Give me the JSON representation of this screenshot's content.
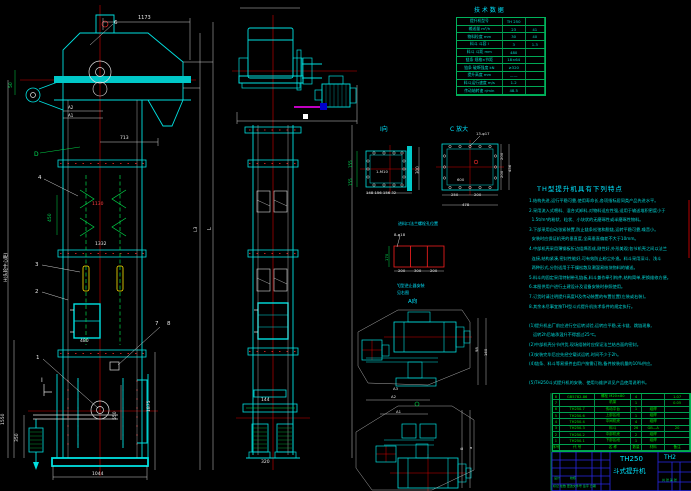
{
  "drawing": {
    "sheet_title": "TH250 斗式提升机",
    "accent_colors": {
      "cyan": "#00e0e0",
      "green": "#00d84a",
      "red": "#ff2e2e",
      "white": "#d8d8d8",
      "yellow": "#ffe800",
      "magenta": "#ff00ff",
      "blue": "#2828e8"
    }
  },
  "features": {
    "title": "TH型提升机具有下列特点",
    "lines": [
      "1.结构先进,运行平稳可靠,使用寿命长,各项指标居同类产品先进水平。",
      "2.采用流入式喂料、混合式卸料,对物料适应性强,适用于输送堆积密度小于",
      "  1.5t/m³的粉状、粒状、小块状的无磨琢性或半磨琢性物料。",
      "3.下部采用自动张紧装置,防止链条松弛和脱链,运转平稳可靠,噪音小。",
      "  安装时应保证机壳的垂直度,全高垂直偏差不大于10mm。",
      "4.中部机壳采用薄钢板折边组焊而成,刚性好,外形美观;各节机壳之间以法兰",
      "  连接,结构紧凑,密封性能好,可有效防止粉尘外逸。料斗采用深斗、浅斗",
      "  两种形式,分别适用于干燥松散及潮湿易结块物料的输送。",
      "5.料斗的固定采用特制带孔链板,料斗兼作牵引构件,结构简单,更换维修方便。",
      "6.本图供用户进行土建设计及设备安装时参照使用。",
      "7.订货时请注明提升高度H及传动装置的布置位置(左装或右装)。",
      "8.其余未尽事宜按TH型斗式提升机技术条件的规定执行。",
      "",
      "(1)提升机出厂前应进行空运转试验,运转应平稳,无卡链、跳链现象,",
      "   运转2h后轴承温升不得超过25℃。",
      "(2)中部机壳分节供货,现场组装时应保证法兰结合面的密封。",
      "(3)安装完毕后应先经空载试运转,时间不少于2h。",
      "(4)链条、料斗等易损件由用户按需订购,备件按装机量的10%供应。",
      "",
      "(5)TH250斗式提升机的安装、使用与维护详见产品使用说明书。"
    ]
  },
  "tech": {
    "title": "技 术 数 据",
    "rows": [
      [
        "提升机型号",
        "TH 250",
        ""
      ],
      [
        "输送量 m³/h",
        "23",
        "41"
      ],
      [
        "物料粒度 mm",
        "30",
        "40"
      ],
      [
        "料斗 斗容 l",
        "3",
        "1.3"
      ],
      [
        "料斗 斗距 mm",
        "480",
        ""
      ],
      [
        "链条 规格×节距",
        "18×64",
        ""
      ],
      [
        "链条 破断强度 kN",
        "≥320",
        ""
      ],
      [
        "提升高度 mm",
        "——",
        ""
      ],
      [
        "料斗运行速度 m/s",
        "1.2",
        ""
      ],
      [
        "传动轴转速 r/min",
        "48.5",
        ""
      ]
    ]
  },
  "bom": {
    "rows": [
      [
        "8",
        "GB5782-86",
        "螺栓 M20×80",
        "4",
        "",
        "1.07"
      ],
      [
        "7",
        "",
        "机架",
        "1",
        "",
        "0.05"
      ],
      [
        "6",
        "TH250.7",
        "传动平台",
        "1",
        "组焊",
        ""
      ],
      [
        "5",
        "TH250.6",
        "上部区段",
        "1",
        "组焊",
        ""
      ],
      [
        "4",
        "TH250.4",
        "中间机壳",
        "4",
        "组焊",
        ""
      ],
      [
        "3",
        "TH250.3",
        "料斗",
        "26",
        "GB—A",
        "20"
      ],
      [
        "2",
        "TH250.2",
        "中部机壳",
        "2",
        "组焊",
        ""
      ],
      [
        "1",
        "TH250.1",
        "下部区段",
        "1",
        "组焊",
        ""
      ],
      [
        "序号",
        "代 号",
        "名 称",
        "数量",
        "材料",
        "备注"
      ]
    ]
  },
  "annotations": [
    {
      "n": "dim-1173",
      "t": "1173",
      "x": 138,
      "y": 16,
      "s": 5,
      "c": "w"
    },
    {
      "n": "part-label-6",
      "t": "6",
      "x": 114,
      "y": 21,
      "s": 5.5,
      "c": "w"
    },
    {
      "n": "dim-50",
      "t": "50",
      "x": 10,
      "y": 88,
      "s": 4.5,
      "c": "g",
      "r": 1
    },
    {
      "n": "dim-label-A2",
      "t": "A2",
      "x": 68,
      "y": 106,
      "s": 4,
      "c": "w"
    },
    {
      "n": "dim-label-A1",
      "t": "A1",
      "x": 68,
      "y": 113.5,
      "s": 4,
      "c": "w"
    },
    {
      "n": "dim-713",
      "t": "713",
      "x": 120,
      "y": 137,
      "s": 4.5,
      "c": "w"
    },
    {
      "n": "section-label-D",
      "t": "D",
      "x": 34,
      "y": 152,
      "s": 6,
      "c": "g"
    },
    {
      "n": "part-label-4",
      "t": "4",
      "x": 38,
      "y": 176,
      "s": 5.5,
      "c": "w"
    },
    {
      "n": "dim-450",
      "t": "450",
      "x": 49,
      "y": 222,
      "s": 4.5,
      "c": "g",
      "r": 1
    },
    {
      "n": "dim-1130",
      "t": "1130",
      "x": 92,
      "y": 203,
      "s": 4.5,
      "c": "r"
    },
    {
      "n": "dim-1332",
      "t": "1332",
      "x": 95,
      "y": 243,
      "s": 4.5,
      "c": "w"
    },
    {
      "n": "part-label-3",
      "t": "3",
      "x": 35,
      "y": 263,
      "s": 5.5,
      "c": "w"
    },
    {
      "n": "part-label-2",
      "t": "2",
      "x": 35,
      "y": 290,
      "s": 5.5,
      "c": "w"
    },
    {
      "n": "part-label-7",
      "t": "7",
      "x": 155,
      "y": 322,
      "s": 5.5,
      "c": "w"
    },
    {
      "n": "part-label-8",
      "t": "8",
      "x": 167,
      "y": 322,
      "s": 5.5,
      "c": "w"
    },
    {
      "n": "dim-480",
      "t": "480",
      "x": 80,
      "y": 340,
      "s": 4.5,
      "c": "w"
    },
    {
      "n": "part-label-1",
      "t": "1",
      "x": 36,
      "y": 356,
      "s": 5.5,
      "c": "w"
    },
    {
      "n": "section-label-I",
      "t": "I",
      "x": 41,
      "y": 378,
      "s": 6,
      "c": "w"
    },
    {
      "n": "dim-550",
      "t": "550",
      "x": 114,
      "y": 420,
      "s": 4.5,
      "c": "w",
      "r": 1
    },
    {
      "n": "dim-1875",
      "t": "1875",
      "x": 148,
      "y": 412,
      "s": 4.5,
      "c": "w",
      "r": 1
    },
    {
      "n": "dim-1550",
      "t": "1550",
      "x": 2,
      "y": 425,
      "s": 4.5,
      "c": "w",
      "r": 1
    },
    {
      "n": "dim-350",
      "t": "350",
      "x": 16,
      "y": 442,
      "s": 4.5,
      "c": "w",
      "r": 1
    },
    {
      "n": "dim-1044",
      "t": "1044",
      "x": 92,
      "y": 473,
      "s": 4.5,
      "c": "w"
    },
    {
      "n": "dim-H-height",
      "t": "H(头轮中心距)",
      "x": 5,
      "y": 282,
      "s": 4.5,
      "c": "w",
      "r": 1
    },
    {
      "n": "dim-L3",
      "t": "L3",
      "x": 195,
      "y": 232,
      "s": 4.5,
      "c": "w",
      "r": 1
    },
    {
      "n": "dim-L",
      "t": "L",
      "x": 208,
      "y": 230,
      "s": 5,
      "c": "w",
      "r": 1
    },
    {
      "n": "dim-144",
      "t": "144",
      "x": 261,
      "y": 399,
      "s": 4.5,
      "c": "w"
    },
    {
      "n": "dim-320",
      "t": "320",
      "x": 261,
      "y": 461,
      "s": 4.5,
      "c": "w"
    },
    {
      "n": "view-label-I",
      "t": "I向",
      "x": 380,
      "y": 127,
      "s": 6,
      "c": "c"
    },
    {
      "n": "dim-155-upper",
      "t": "155",
      "x": 349,
      "y": 168,
      "s": 4,
      "c": "g",
      "r": 1
    },
    {
      "n": "dim-155-lower",
      "t": "155",
      "x": 349,
      "y": 186,
      "s": 4,
      "c": "g",
      "r": 1
    },
    {
      "n": "dim-300",
      "t": "300",
      "x": 416,
      "y": 174,
      "s": 4,
      "c": "w",
      "r": 1
    },
    {
      "n": "hole-label-1-M10",
      "t": "1-M10",
      "x": 376,
      "y": 170,
      "s": 3.8,
      "c": "w"
    },
    {
      "n": "dim-I-bottom-row",
      "t": "148 156 156 32",
      "x": 366,
      "y": 191,
      "s": 3.8,
      "c": "w"
    },
    {
      "n": "view-label-C",
      "t": "C 放大",
      "x": 450,
      "y": 127,
      "s": 6,
      "c": "c"
    },
    {
      "n": "hole-label-13",
      "t": "13-φ17",
      "x": 476,
      "y": 132,
      "s": 3.8,
      "c": "w"
    },
    {
      "n": "dim-600",
      "t": "600",
      "x": 457,
      "y": 178,
      "s": 3.8,
      "c": "w"
    },
    {
      "n": "dim-250",
      "t": "250",
      "x": 451,
      "y": 193,
      "s": 3.8,
      "c": "w"
    },
    {
      "n": "dim-200-bottom",
      "t": "200",
      "x": 474,
      "y": 193,
      "s": 3.8,
      "c": "w"
    },
    {
      "n": "dim-478",
      "t": "478",
      "x": 462,
      "y": 203,
      "s": 3.8,
      "c": "w"
    },
    {
      "n": "dim-200-right-a",
      "t": "200",
      "x": 500,
      "y": 160,
      "s": 3.8,
      "c": "w",
      "r": 1
    },
    {
      "n": "dim-200-right-b",
      "t": "200",
      "x": 500,
      "y": 178,
      "s": 3.8,
      "c": "w",
      "r": 1
    },
    {
      "n": "dim-456",
      "t": "456",
      "x": 508,
      "y": 172,
      "s": 3.8,
      "c": "w",
      "r": 1
    },
    {
      "n": "inlet-flange-title",
      "t": "进料口法兰螺栓孔位置",
      "x": 398,
      "y": 222,
      "s": 4,
      "c": "c"
    },
    {
      "n": "hole-label-8",
      "t": "8-φ18",
      "x": 394,
      "y": 233,
      "s": 3.8,
      "c": "w"
    },
    {
      "n": "dim-170",
      "t": "170",
      "x": 385,
      "y": 261,
      "s": 3.8,
      "c": "g",
      "r": 1
    },
    {
      "n": "dim-grid-200a",
      "t": "200",
      "x": 398,
      "y": 269,
      "s": 3.8,
      "c": "w"
    },
    {
      "n": "dim-grid-300",
      "t": "300",
      "x": 414,
      "y": 269,
      "s": 3.8,
      "c": "w"
    },
    {
      "n": "dim-grid-200b",
      "t": "200",
      "x": 430,
      "y": 269,
      "s": 3.8,
      "c": "w"
    },
    {
      "n": "backstop-note-1",
      "t": "YJ型逆止器安装",
      "x": 397,
      "y": 284,
      "s": 4,
      "c": "c"
    },
    {
      "n": "backstop-note-2",
      "t": "见右图",
      "x": 397,
      "y": 291,
      "s": 4,
      "c": "c"
    },
    {
      "n": "view-label-A",
      "t": "A向",
      "x": 408,
      "y": 300,
      "s": 5.5,
      "c": "c"
    },
    {
      "n": "dim-98",
      "t": "98",
      "x": 475,
      "y": 352,
      "s": 3.8,
      "c": "w",
      "r": 1
    },
    {
      "n": "dim-160",
      "t": "160",
      "x": 484,
      "y": 356,
      "s": 3.8,
      "c": "w",
      "r": 1
    },
    {
      "n": "dim-label-A3",
      "t": "A3",
      "x": 393,
      "y": 387,
      "s": 3.8,
      "c": "w"
    },
    {
      "n": "dim-label-A2-lower",
      "t": "A2",
      "x": 391,
      "y": 395,
      "s": 3.8,
      "c": "w"
    },
    {
      "n": "dim-label-A1-lower",
      "t": "A1",
      "x": 396,
      "y": 410,
      "s": 3.8,
      "c": "w"
    },
    {
      "n": "dim-B",
      "t": "B",
      "x": 460,
      "y": 450,
      "s": 3.8,
      "c": "w",
      "r": 1
    },
    {
      "n": "dim-a",
      "t": "a",
      "x": 469,
      "y": 449,
      "s": 3.8,
      "c": "w",
      "r": 1
    },
    {
      "n": "tech-table-title",
      "t": "技 术 数 据",
      "x": 474,
      "y": 8,
      "s": 6,
      "c": "c"
    },
    {
      "n": "titleblock-model",
      "t": "TH250",
      "x": 620,
      "y": 456,
      "s": 7,
      "c": "c"
    },
    {
      "n": "titleblock-name",
      "t": "斗式提升机",
      "x": 613,
      "y": 468,
      "s": 6.5,
      "c": "c"
    },
    {
      "n": "titleblock-right-partial",
      "t": "TH2",
      "x": 664,
      "y": 455,
      "s": 6,
      "c": "c"
    },
    {
      "n": "titleblock-sign-row",
      "t": "标记 处数 更改文件号 签字 日期",
      "x": 553,
      "y": 485,
      "s": 3,
      "c": "g"
    },
    {
      "n": "titleblock-design",
      "t": "设计",
      "x": 554,
      "y": 477,
      "s": 3,
      "c": "g"
    },
    {
      "n": "titleblock-check",
      "t": "校核",
      "x": 570,
      "y": 477,
      "s": 3,
      "c": "g"
    },
    {
      "n": "titleblock-sheet",
      "t": "共 张 第 张",
      "x": 662,
      "y": 479,
      "s": 3,
      "c": "g"
    }
  ]
}
